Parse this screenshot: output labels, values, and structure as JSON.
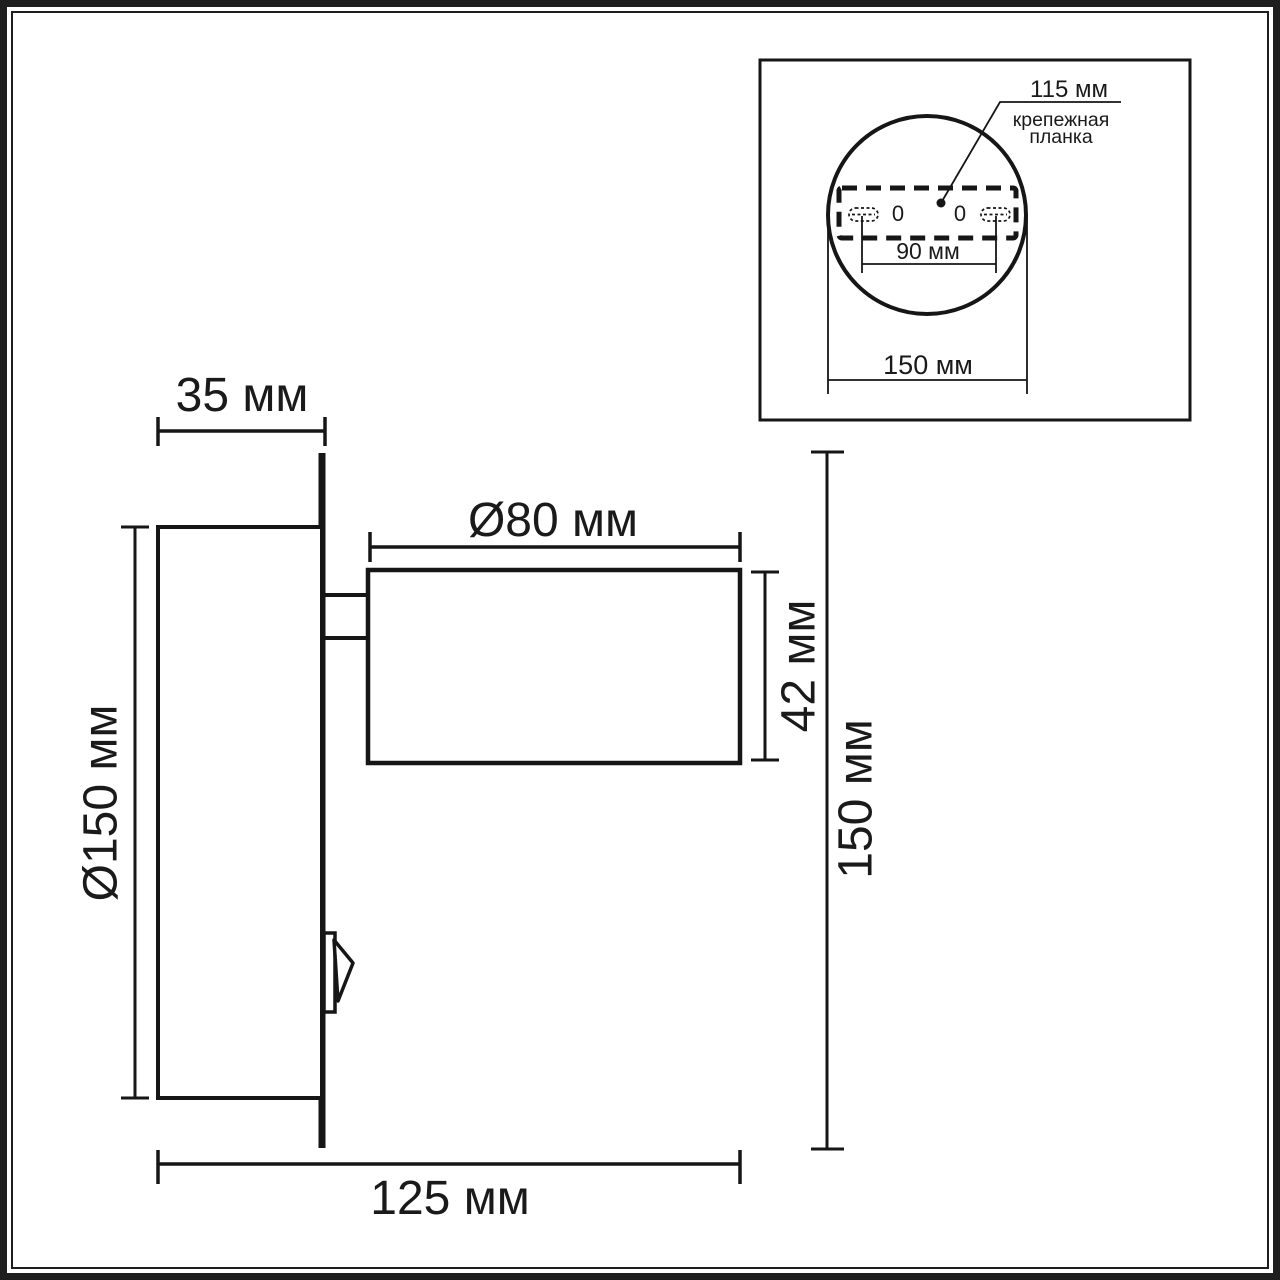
{
  "drawing": {
    "kind": "wall-spot-lamp dimensional drawing",
    "units": "мм",
    "colors": {
      "line": "#1a1a1a",
      "background": "#ffffff"
    },
    "main_view": {
      "labels": {
        "base_depth": "35 мм",
        "base_diameter": "Ø150 мм",
        "head_diameter": "Ø80 мм",
        "head_height": "42 мм",
        "overall_height": "150 мм",
        "overall_depth": "125 мм"
      }
    },
    "inset_view": {
      "labels": {
        "mounting_plate_width": "115 мм",
        "mounting_plate_name_line1": "крепежная",
        "mounting_plate_name_line2": "планка",
        "hole_spacing": "90 мм",
        "base_diameter": "150 мм",
        "slot_mark_left": "0",
        "slot_mark_right": "0"
      }
    }
  }
}
